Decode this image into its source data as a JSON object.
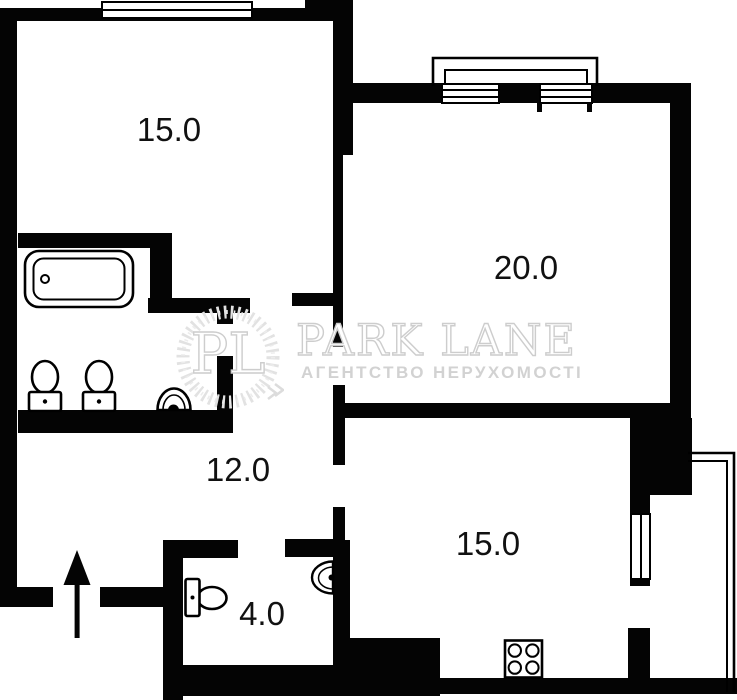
{
  "watermark": {
    "monogram": "PL",
    "brand": "PARK LANE",
    "subtitle": "АГЕНТСТВО НЕРУХОМОСТІ",
    "color": "#d2d2d2"
  },
  "rooms": {
    "top_left": {
      "label": "15.0"
    },
    "top_right": {
      "label": "20.0"
    },
    "hallway": {
      "label": "12.0"
    },
    "kitchen": {
      "label": "15.0"
    },
    "wc": {
      "label": "4.0"
    }
  },
  "colors": {
    "wall": "#040404",
    "background": "#ffffff",
    "label_text": "#111111"
  },
  "icons": [
    "bathtub-icon",
    "toilet-icon",
    "sink-icon",
    "stove-icon",
    "entrance-arrow-icon",
    "window-icon",
    "balcony-outline",
    "laurel-wreath-icon"
  ]
}
